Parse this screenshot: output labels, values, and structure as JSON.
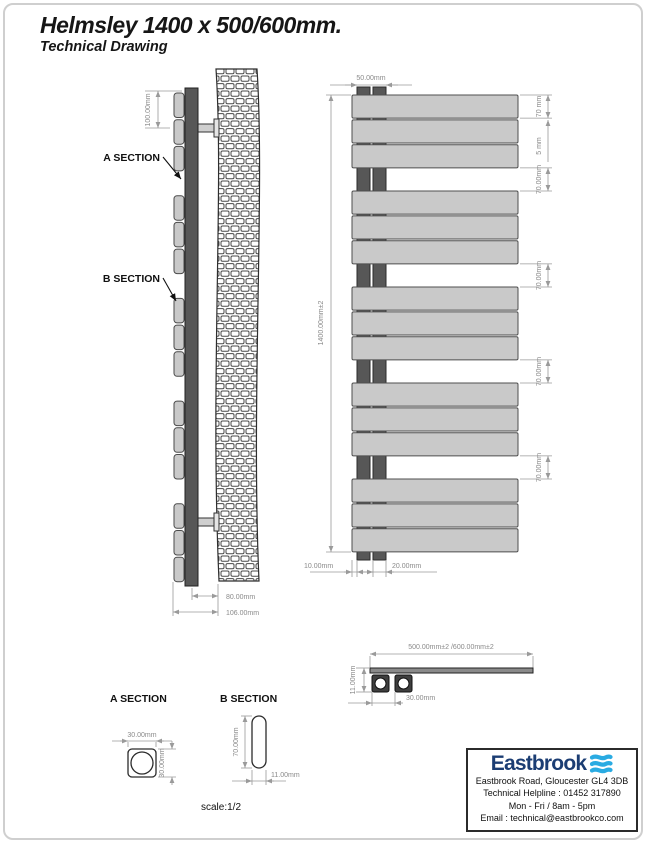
{
  "header": {
    "title": "Helmsley 1400 x 500/600mm.",
    "subtitle": "Technical Drawing"
  },
  "side_view": {
    "a_section_label": "A SECTION",
    "b_section_label": "B SECTION",
    "dim_bracket": "100.00mm",
    "dim_depth": "80.00mm",
    "dim_overall_depth": "106.00mm"
  },
  "front_view": {
    "structure": {
      "groups": 5,
      "panels_per_group": 3
    },
    "dim_tube_spacing": "50.00mm",
    "dim_height": "1400.00mm±2",
    "dim_panel_height": "70 mm",
    "dim_panel_gap": "5 mm",
    "dim_group_gap": "70.00mm",
    "dim_bottom_offset": "10.00mm",
    "dim_tube_pitch": "20.00mm"
  },
  "top_view": {
    "dim_width": "500.00mm±2 /600.00mm±2",
    "dim_thickness": "11.00mm",
    "dim_tube_pitch": "30.00mm"
  },
  "section_a": {
    "label": "A SECTION",
    "dim_width": "30.00mm",
    "dim_height": "30.00mm"
  },
  "section_b": {
    "label": "B SECTION",
    "dim_height": "70.00mm",
    "dim_width": "11.00mm"
  },
  "scale_note": "scale:1/2",
  "info_box": {
    "brand": "Eastbrook",
    "address": "Eastbrook Road, Gloucester GL4 3DB",
    "helpline": "Technical Helpline : 01452 317890",
    "hours": "Mon - Fri / 8am - 5pm",
    "email": "Email : technical@eastbrookco.com"
  },
  "colors": {
    "panel": "#c9c9c9",
    "tube": "#575757",
    "outline": "#2b2b2b",
    "dim": "#9a9a9a",
    "brand_navy": "#1b3d73",
    "brand_blue": "#2aabe2"
  }
}
